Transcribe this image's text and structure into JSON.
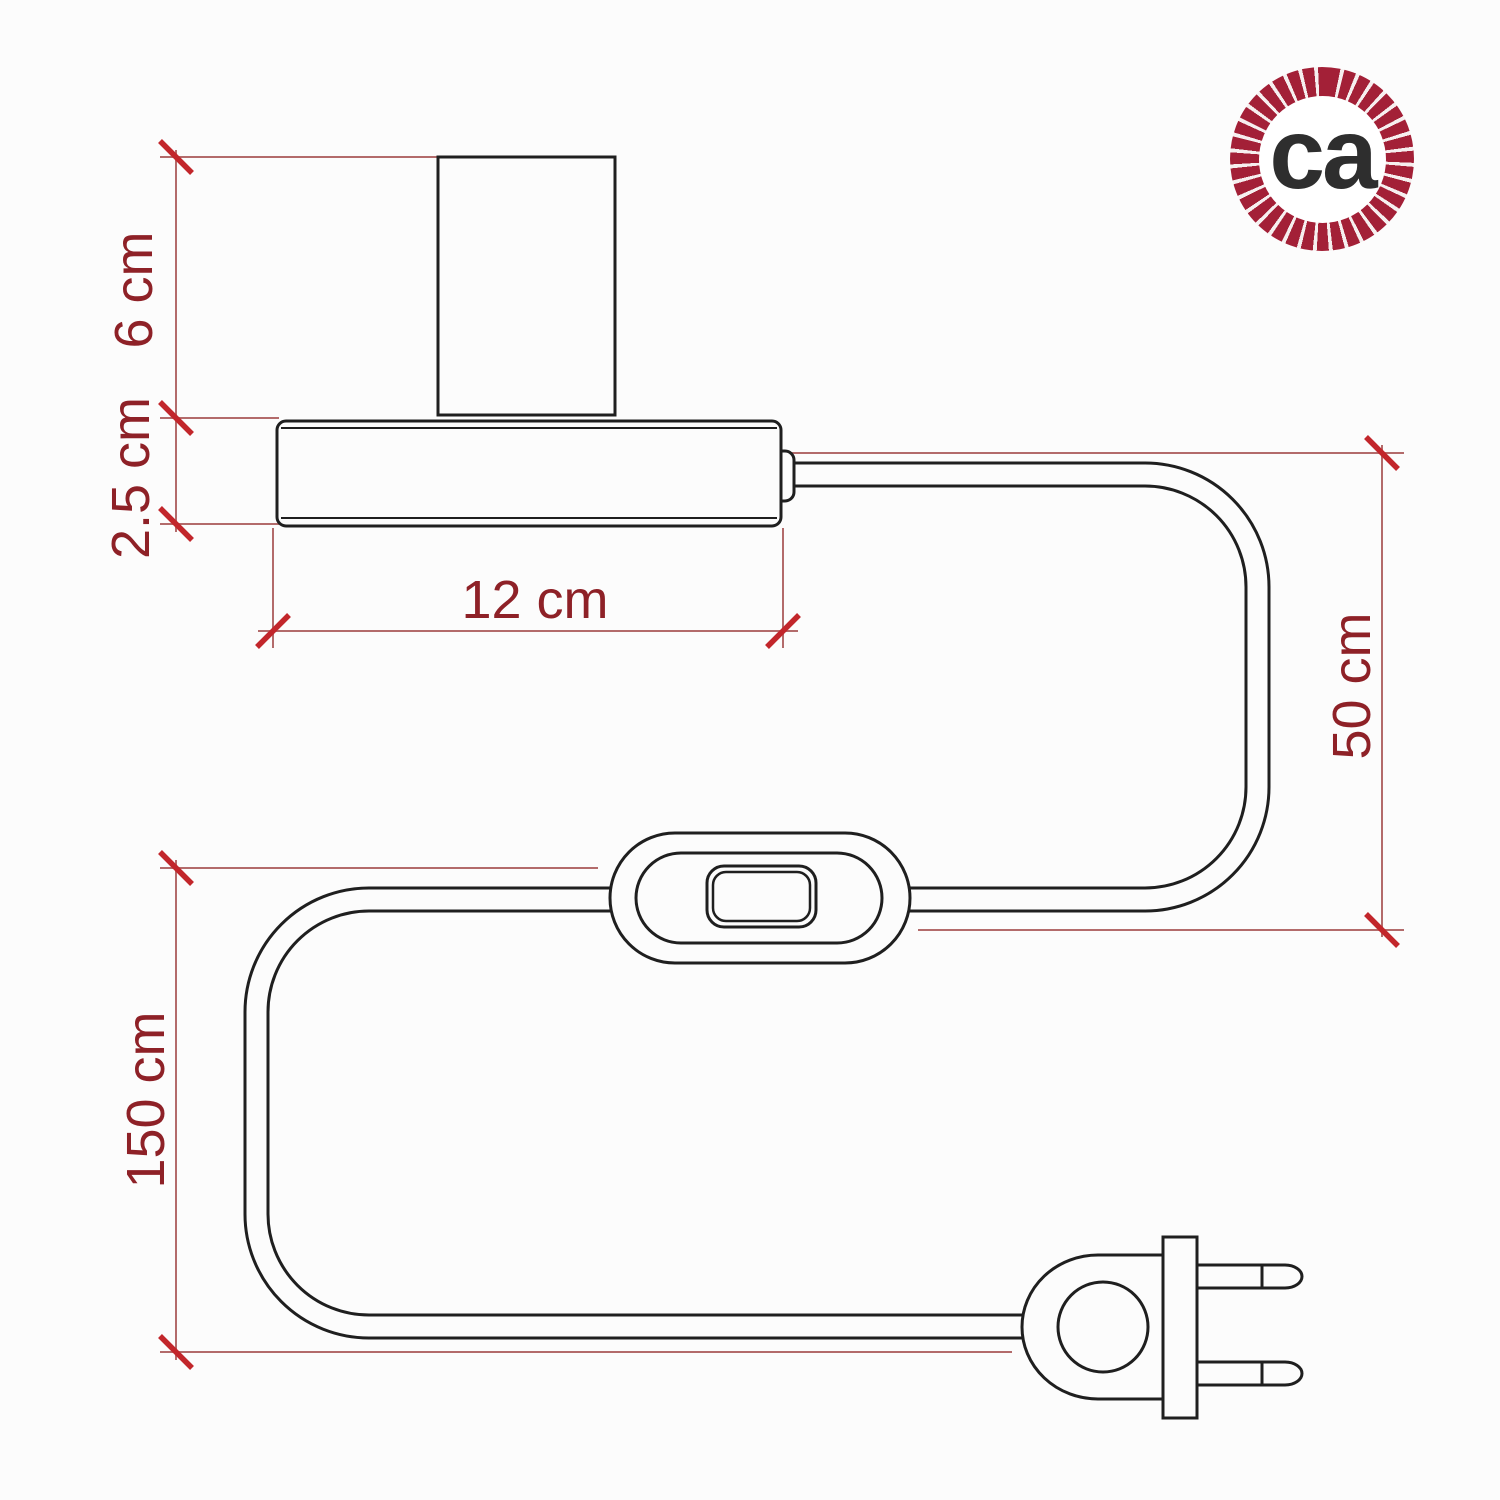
{
  "logo": {
    "text": "ca",
    "ring_color": "#a32037",
    "text_color": "#2e2e2e"
  },
  "colors": {
    "background": "#fcfcfc",
    "drawing_outline": "#1f1f1f",
    "dimension_line": "#b36b6b",
    "tick_mark": "#c2262b",
    "dimension_label": "#8e2127"
  },
  "dimensions": {
    "socket_height": {
      "label": "6 cm"
    },
    "base_height": {
      "label": "2.5 cm"
    },
    "base_width": {
      "label": "12 cm"
    },
    "cable_to_switch": {
      "label": "50 cm"
    },
    "cable_total": {
      "label": "150 cm"
    }
  }
}
